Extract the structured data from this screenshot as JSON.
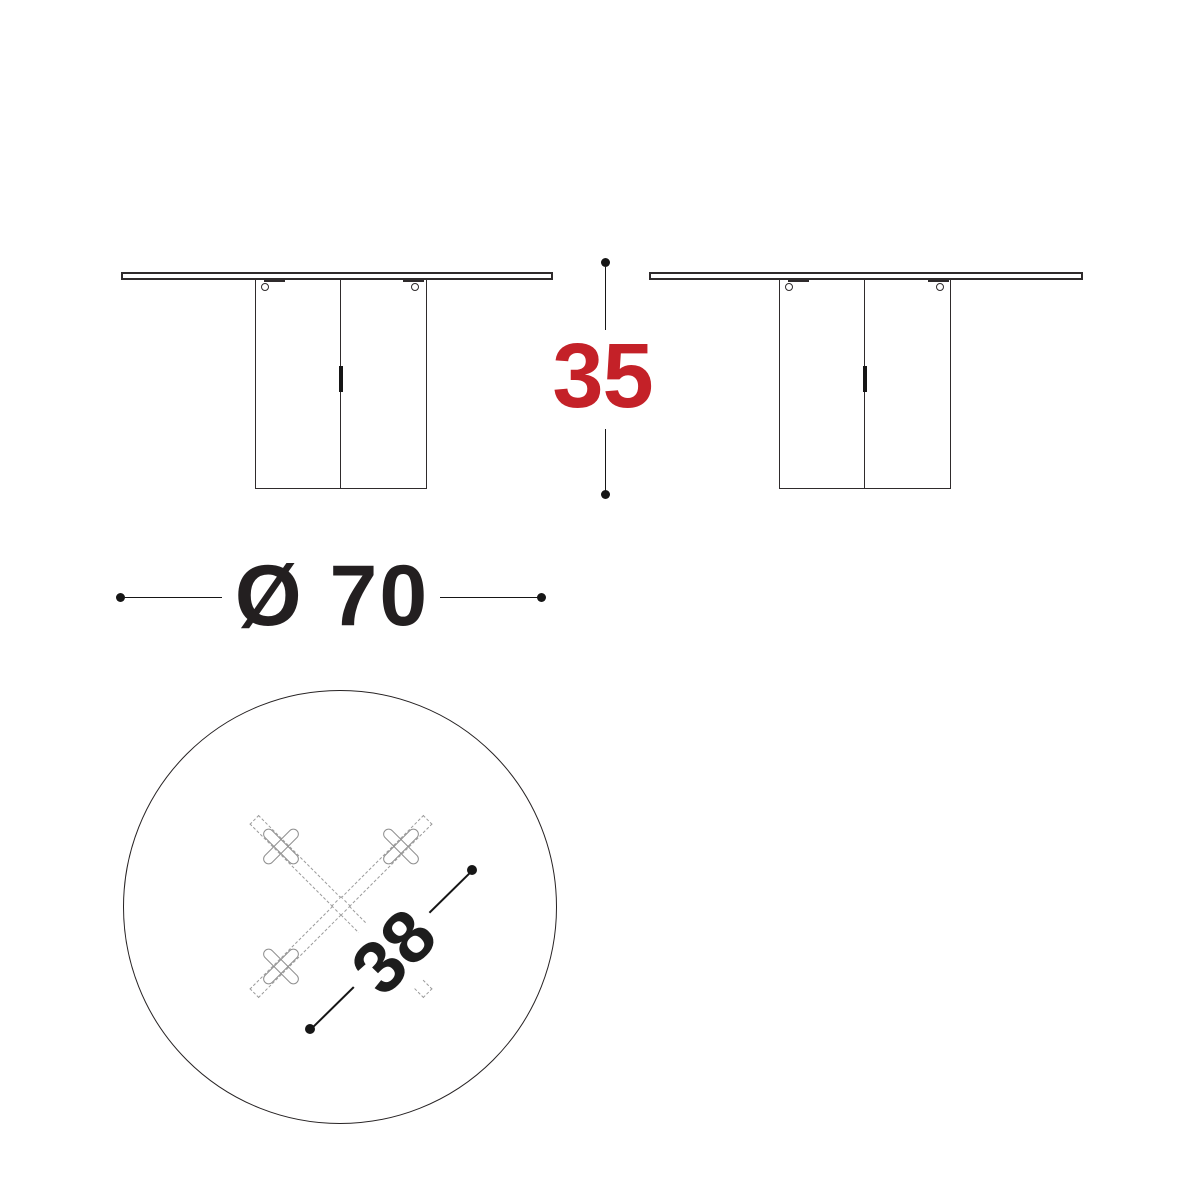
{
  "colors": {
    "line": "#2f2b2c",
    "dimension_line": "#161616",
    "detail_gray": "#9c9c9c",
    "accent_red": "#c42128",
    "text_dark": "#1d1d1d"
  },
  "icons": {
    "cam_lock": "small-circle-with-tab-line",
    "dimension_endpoint": "filled-dot"
  },
  "dims": {
    "height": {
      "label": "35"
    },
    "diameter": {
      "label": "Ø 70"
    },
    "base": {
      "label": "38"
    }
  }
}
